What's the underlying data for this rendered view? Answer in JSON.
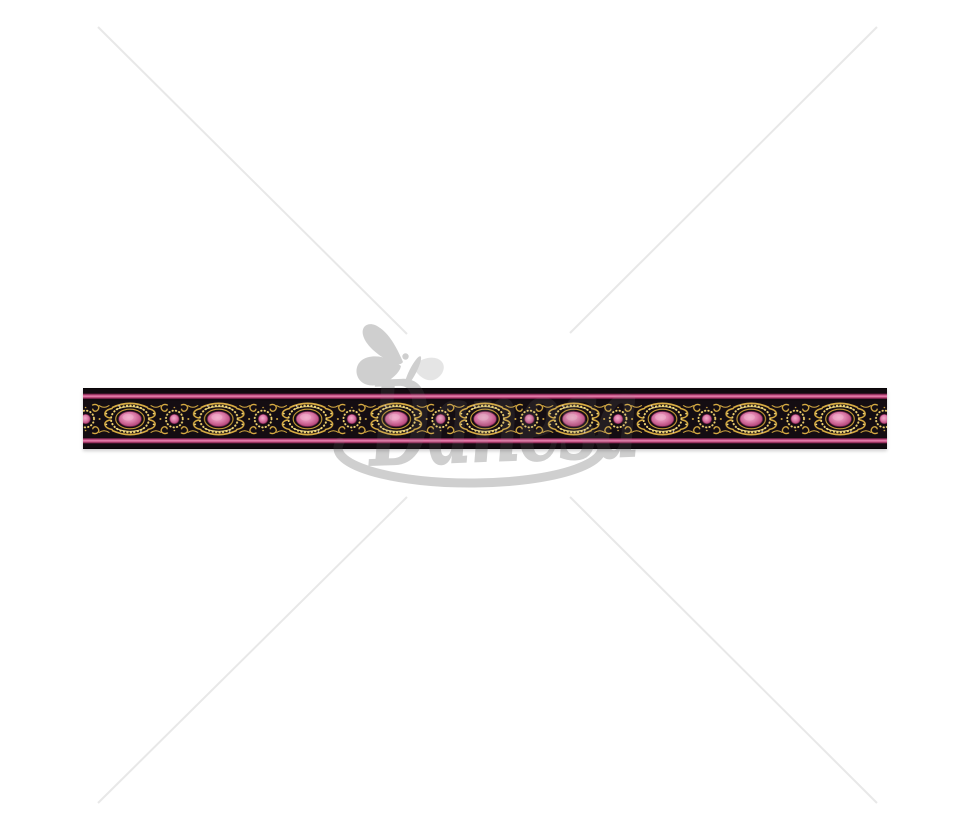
{
  "page": {
    "background_color": "#ffffff",
    "content_type": "product photo of decorative jacquard ribbon trim"
  },
  "watermark": {
    "brand_text": "Danesa",
    "logo_icon": "butterfly-icon",
    "color_on_white": "#d7d7d7",
    "diagonal_lines_color": "#e8e8e8",
    "elements": [
      "butterfly",
      "script brand text",
      "elliptical swoosh underline",
      "four diagonal corner lines crossing at center"
    ]
  },
  "ribbon": {
    "description": "black jacquard trim with metallic gold scrollwork, alternating large pink oval medallions and small pink dot medallions, magenta edge stripes",
    "colors": {
      "base_black": "#130c11",
      "stripe_pink": "#e585b1",
      "stripe_pink_dark": "#4a1030",
      "gold": "#d7ab42",
      "gold_highlight": "#f3dd82",
      "medallion_pink": "#dd7fab",
      "medallion_pink_light": "#f2aecb"
    },
    "large_medallion_count": 9,
    "small_medallion_count": 10
  }
}
